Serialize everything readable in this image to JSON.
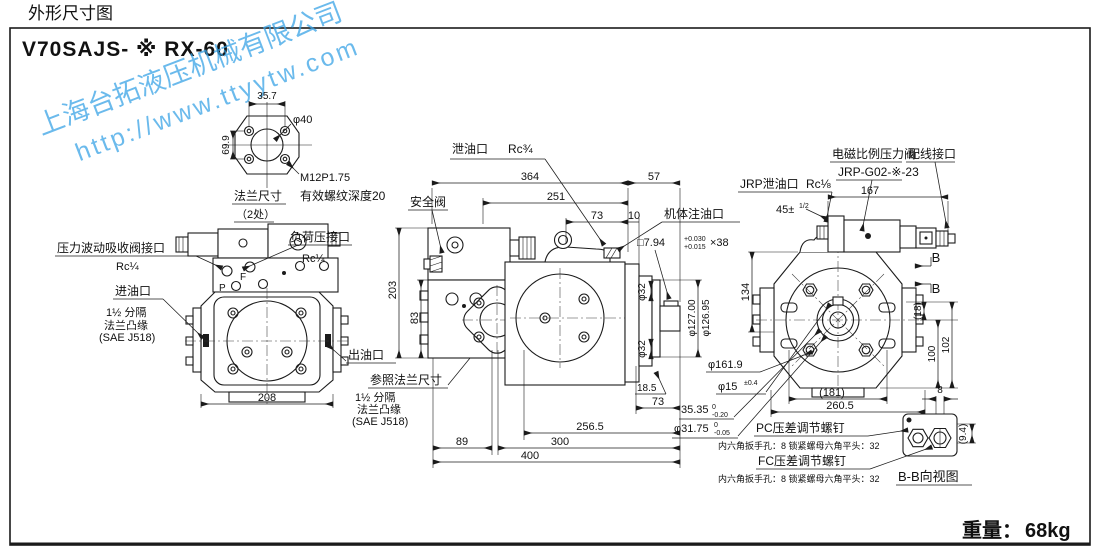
{
  "page": {
    "title": "外形尺寸图",
    "model": "V70SAJS- ※ RX-60",
    "weight_label": "重量：",
    "weight_value": "68kg"
  },
  "watermark": {
    "line1": "上海台拓液压机械有限公司",
    "line2": "http://www.ttyytw.com",
    "color": "#3aa4e6"
  },
  "flange": {
    "name": "法兰尺寸",
    "places": "（2处）",
    "note": "有效螺纹深度20",
    "thread": "M12P1.75",
    "d35_7": "35.7",
    "d69_9": "69.9",
    "phi40": "φ40"
  },
  "front": {
    "surge": "压力波动吸收阀接口",
    "surge_rc": "Rc¼",
    "load": "负荷压接口",
    "load_rc": "Rc¼",
    "p": "P",
    "f": "F",
    "inlet": "进油口",
    "inlet_l1": "1½ 分隔",
    "inlet_l2": "法兰凸缘",
    "inlet_l3": "(SAE J518)",
    "outlet": "出油口",
    "ref": "参照法兰尺寸",
    "ref_l1": "1½ 分隔",
    "ref_l2": "法兰凸缘",
    "ref_l3": "(SAE J518)",
    "d208": "208"
  },
  "side": {
    "drain": "泄油口",
    "drain_rc": "Rc¾",
    "safety": "安全阀",
    "fill": "机体注油口",
    "key": "□7.94",
    "key_tu": "+0.030",
    "key_tl": "+0.015",
    "key_len": "×38",
    "d364": "364",
    "d57": "57",
    "d251": "251",
    "d73t": "73",
    "d10": "10",
    "d203": "203",
    "d83": "83",
    "phi32a": "φ32",
    "phi32b": "φ32",
    "phi127": "φ127.00",
    "phi126": "φ126.95",
    "d18_5": "18.5",
    "d73b": "73",
    "d256_5": "256.5",
    "d89": "89",
    "d300": "300",
    "d400": "400"
  },
  "rear": {
    "valve": "电磁比例压力阀",
    "wiring": "配线接口",
    "valve_model": "JRP-G02-※-23",
    "jrp": "JRP泄油口",
    "jrp_rc": "Rc⅛",
    "d45": "45±",
    "d45_frac": "1/2",
    "d167": "167",
    "d134": "134",
    "d18": "(18)",
    "d100": "100",
    "d102": "102",
    "d181": "(181)",
    "d260_5": "260.5",
    "phi161_9": "φ161.9",
    "phi15": "φ15",
    "phi15_tol": "±0.4",
    "d35_35": "35.35",
    "d35_35_tu": "0",
    "d35_35_tl": "-0.20",
    "phi31_75": "φ31.75",
    "phi31_75_tu": "0",
    "phi31_75_tl": "-0.05",
    "b1": "B",
    "b2": "B"
  },
  "bb": {
    "pc": "PC压差调节螺钉",
    "pc_note": "内六角扳手孔：8 锁紧螺母六角平头：32",
    "fc": "FC压差调节螺钉",
    "fc_note": "内六角扳手孔：8 锁紧螺母六角平头：32",
    "view": "B-B向视图",
    "d8": "8",
    "d9_4": "(9.4)"
  }
}
